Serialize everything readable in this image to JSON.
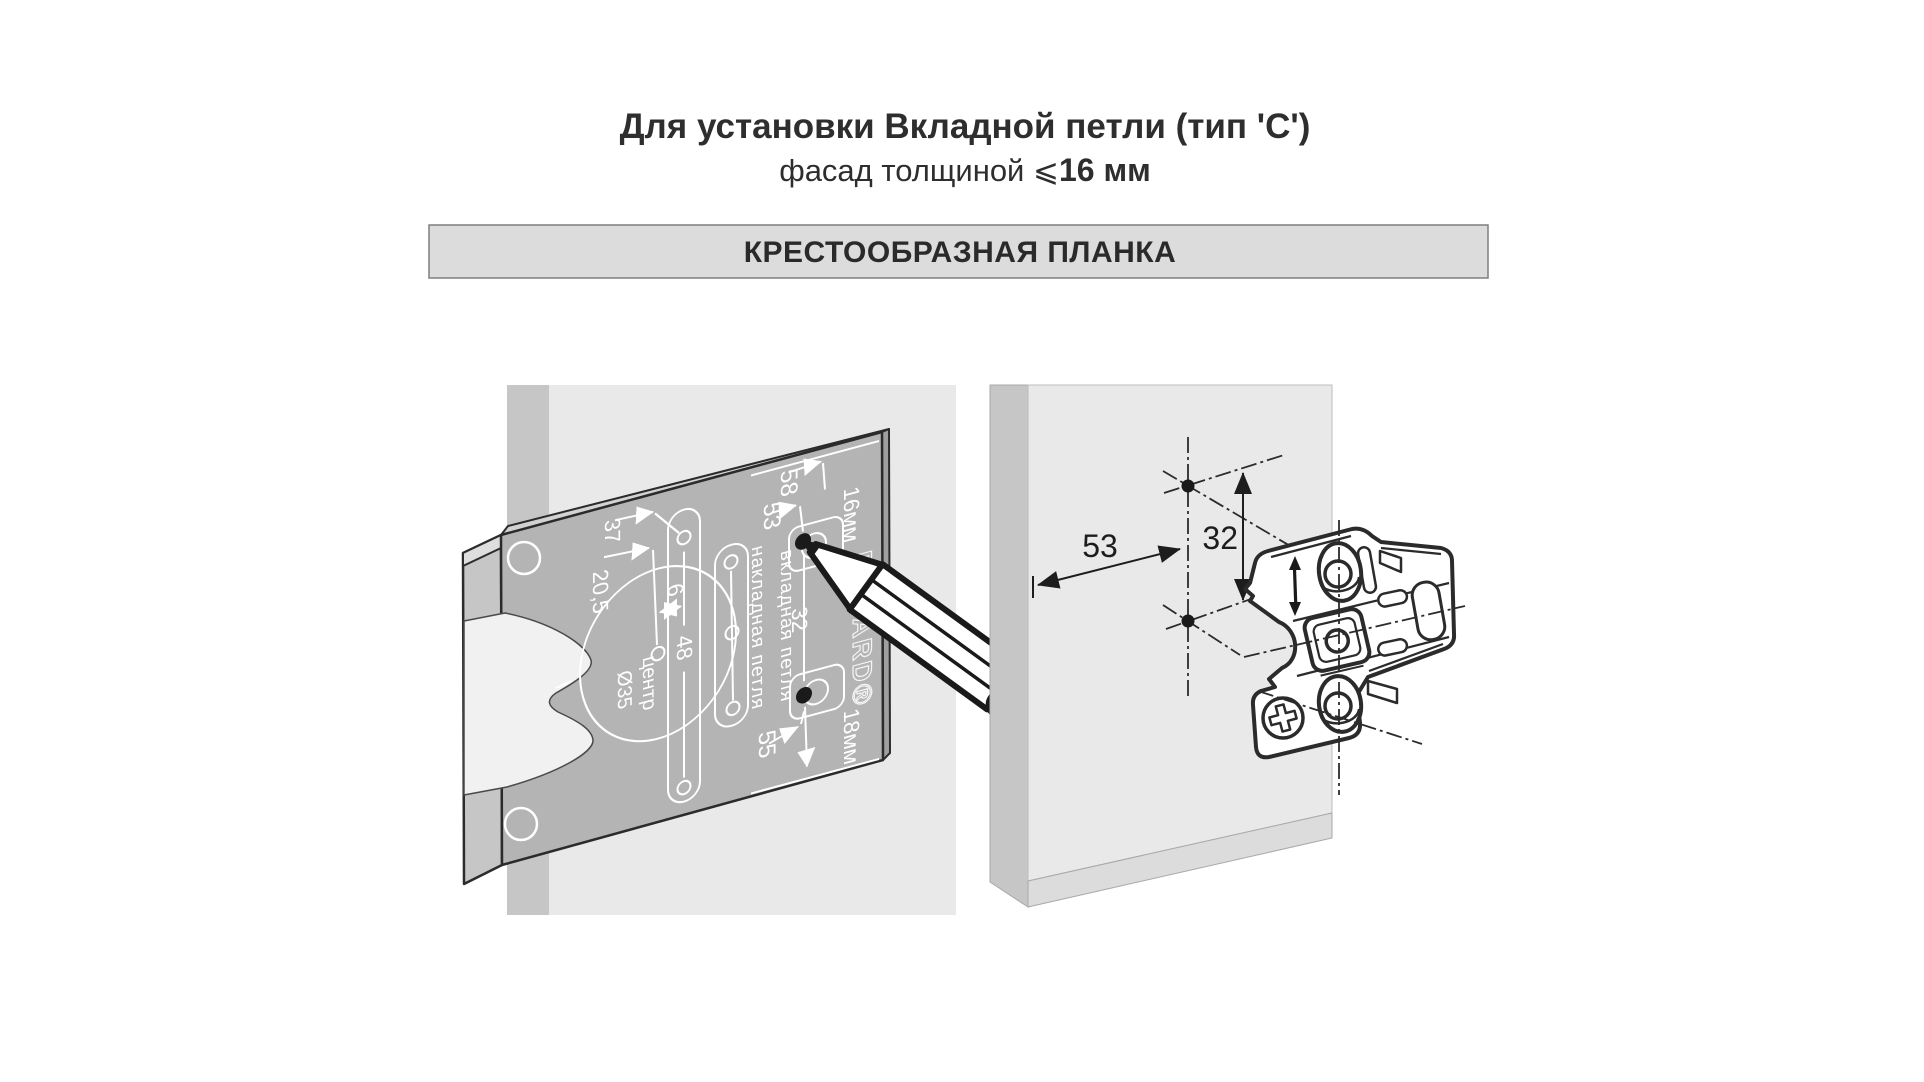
{
  "title": {
    "line1": "Для установки Вкладной петли (тип 'С')",
    "line2_prefix": "фасад толщиной ⩽",
    "line2_bold": "16 мм"
  },
  "header_bar": {
    "label": "КРЕСТООБРАЗНАЯ ПЛАНКА"
  },
  "marking_template": {
    "dim_58": "58",
    "dim_53": "53",
    "dim_37": "37",
    "dim_20_5": "20,5",
    "dim_6": "6",
    "dim_48": "48",
    "center_label_line1": "центр",
    "center_label_line2": "Ø35",
    "overlay_hinge_label": "накладная петля",
    "inset_hinge_label": "вкладная петля",
    "dim_32": "32",
    "dim_55": "55",
    "door_thickness_16": "16мм",
    "door_thickness_18": "18мм",
    "brand": "BOYARD®"
  },
  "drill_markup": {
    "dim_53": "53",
    "dim_32": "32"
  },
  "colors": {
    "panel": "#e9e9e9",
    "panel_edge": "#c6c6c6",
    "panel_bevel": "#dcdcdc",
    "template_face": "#b4b4b4",
    "template_side": "#9f9f9f",
    "template_top": "#d2d2d2",
    "flange": "#c6c6c6",
    "flange_cap": "#dedede",
    "bar_bg": "#dcdcdc",
    "line_dark": "#2b2b2b",
    "white": "#ffffff"
  }
}
